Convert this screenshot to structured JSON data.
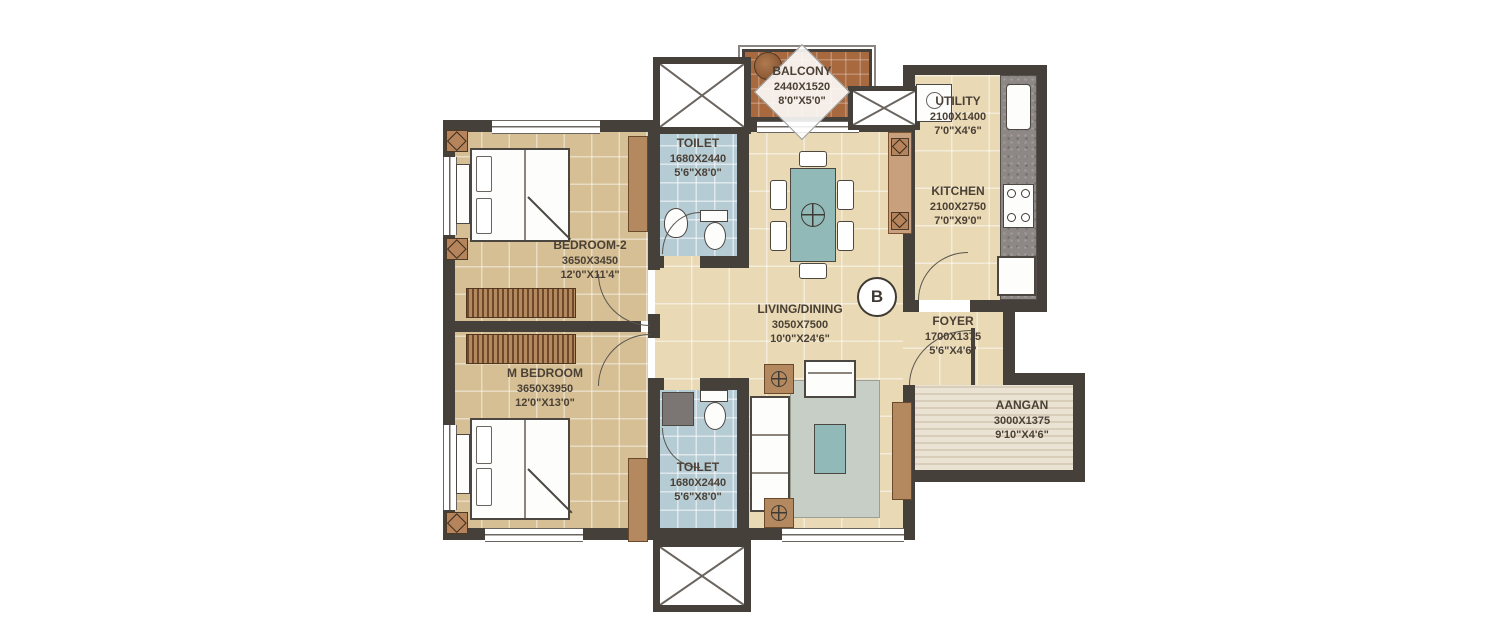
{
  "plan": {
    "unit_label": "B",
    "rooms": [
      {
        "name": "BEDROOM-2",
        "dims_mm": "3650X3450",
        "dims_ft": "12'0\"X11'4\""
      },
      {
        "name": "M BEDROOM",
        "dims_mm": "3650X3950",
        "dims_ft": "12'0\"X13'0\""
      },
      {
        "name": "TOILET",
        "dims_mm": "1680X2440",
        "dims_ft": "5'6\"X8'0\""
      },
      {
        "name": "TOILET",
        "dims_mm": "1680X2440",
        "dims_ft": "5'6\"X8'0\""
      },
      {
        "name": "LIVING/DINING",
        "dims_mm": "3050X7500",
        "dims_ft": "10'0\"X24'6\""
      },
      {
        "name": "BALCONY",
        "dims_mm": "2440X1520",
        "dims_ft": "8'0\"X5'0\""
      },
      {
        "name": "UTILITY",
        "dims_mm": "2100X1400",
        "dims_ft": "7'0\"X4'6\""
      },
      {
        "name": "KITCHEN",
        "dims_mm": "2100X2750",
        "dims_ft": "7'0\"X9'0\""
      },
      {
        "name": "FOYER",
        "dims_mm": "1700X1375",
        "dims_ft": "5'6\"X4'6\""
      },
      {
        "name": "AANGAN",
        "dims_mm": "3000X1375",
        "dims_ft": "9'10\"X4'6\""
      }
    ],
    "colors": {
      "wall": "#46403a",
      "floor_bedroom": "#d6bf94",
      "floor_living": "#e9d9b4",
      "floor_toilet": "#b6ccd5",
      "floor_balcony": "#a8693f",
      "accent_teal": "#90b9b7",
      "wood": "#b5895f",
      "label_text": "#4a4035"
    }
  }
}
